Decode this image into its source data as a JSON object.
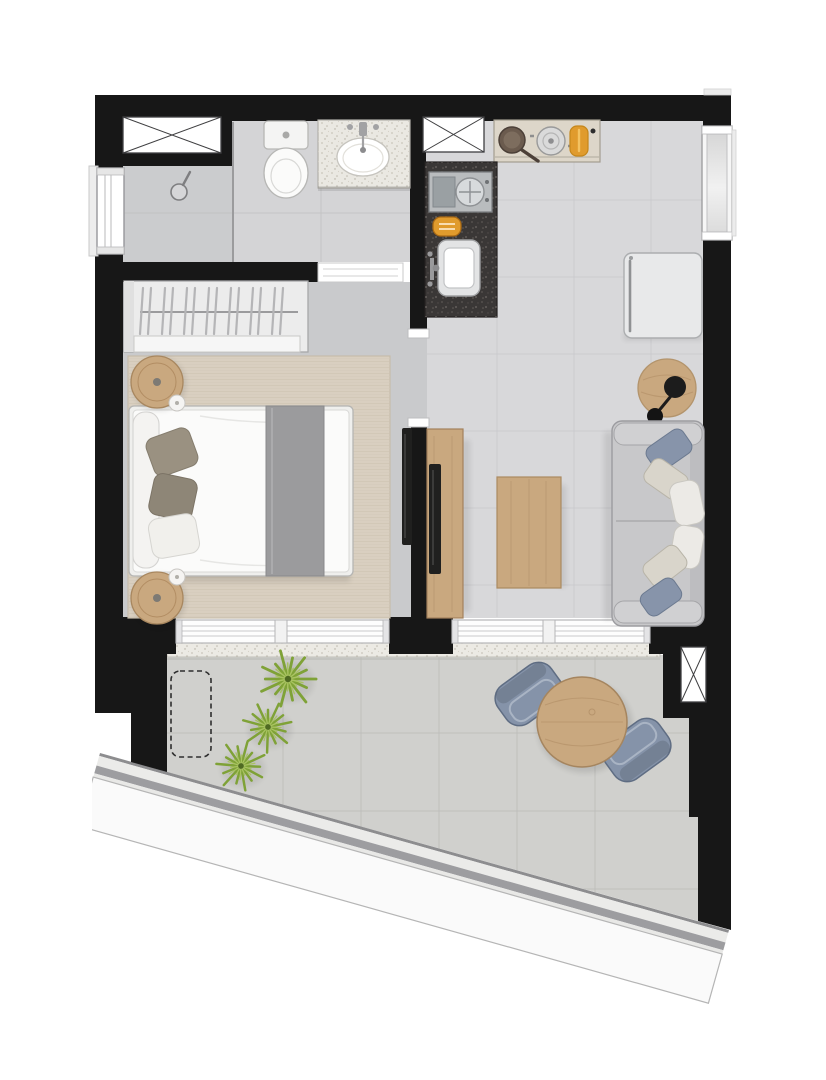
{
  "canvas": {
    "width": 826,
    "height": 1080,
    "background": "#ffffff"
  },
  "palette": {
    "wall": "#171717",
    "floor_living": "#d8d8da",
    "floor_bedroom": "#c9cacc",
    "floor_bath": "#d4d4d6",
    "floor_shower": "#cbccce",
    "floor_balcony": "#d0d0cd",
    "tile_line": "#c7c7ca",
    "rug": "#d9cfc0",
    "wood": "#c9a87f",
    "sofa": "#c8c8ca",
    "cushion_blue": "#8794aa",
    "chair_blue": "#8593a9",
    "granite_dark": "#3a3736",
    "granite_light": "#eae8e2",
    "plant_green": "#7fa237",
    "accent_orange": "#e09b2d",
    "railing_gray": "#9d9da0",
    "tv_black": "#20201f",
    "window_trim": "#ffffff"
  },
  "elements": {
    "windows": [
      "x-cross-window-top-left",
      "x-cross-window-kitchen",
      "x-cross-window-balcony",
      "framed-window-left-wall",
      "recessed-window-right-wall"
    ],
    "bathroom": [
      "shower-head",
      "glass-divider",
      "toilet",
      "washbasin-counter",
      "faucet"
    ],
    "bedroom": [
      "wardrobe-with-hangers",
      "area-rug",
      "double-bed",
      "bed-runner",
      "pillows",
      "nightstand-round",
      "wall-tv"
    ],
    "kitchen": [
      "top-counter-with-pans",
      "dark-granite-counter",
      "built-in-oven",
      "toaster",
      "kitchen-sink",
      "refrigerator"
    ],
    "living": [
      "tv-console",
      "tv-panel",
      "coffee-table",
      "side-table",
      "floor-lamp",
      "sofa-with-cushions"
    ],
    "balcony": [
      "sliding-door-bedroom",
      "sliding-door-living",
      "threshold-sill",
      "dashed-planter-area",
      "plant",
      "round-outdoor-table",
      "outdoor-chair",
      "diagonal-parapet-railing"
    ]
  }
}
